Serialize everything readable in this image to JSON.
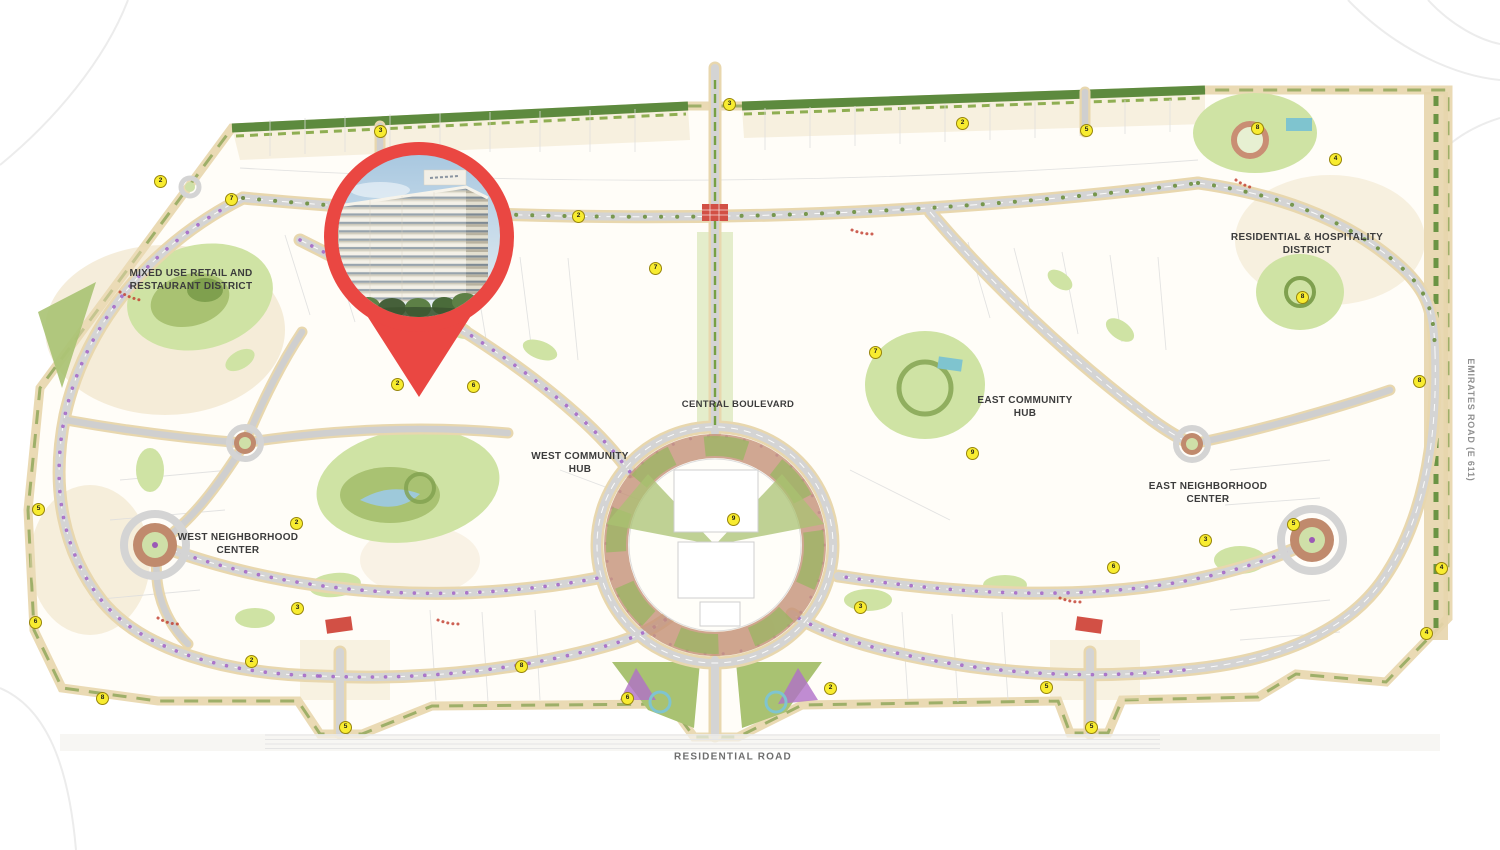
{
  "map": {
    "districts": {
      "mixed_use": "MIXED USE RETAIL AND\nRESTAURANT DISTRICT",
      "central_boulevard": "CENTRAL BOULEVARD",
      "west_community_hub": "WEST COMMUNITY\nHUB",
      "east_community_hub": "EAST COMMUNITY\nHUB",
      "west_neighborhood_center": "WEST NEIGHBORHOOD\nCENTER",
      "east_neighborhood_center": "EAST NEIGHBORHOOD\nCENTER",
      "residential_hospitality": "RESIDENTIAL & HOSPITALITY\nDISTRICT"
    },
    "roads": {
      "residential_road": "RESIDENTIAL ROAD",
      "emirates_road": "EMIRATES ROAD (E 611)"
    },
    "markers": [
      {
        "x": 160,
        "y": 181,
        "n": "2"
      },
      {
        "x": 231,
        "y": 199,
        "n": "7"
      },
      {
        "x": 380,
        "y": 131,
        "n": "3"
      },
      {
        "x": 578,
        "y": 216,
        "n": "2"
      },
      {
        "x": 729,
        "y": 104,
        "n": "3"
      },
      {
        "x": 655,
        "y": 268,
        "n": "7"
      },
      {
        "x": 962,
        "y": 123,
        "n": "2"
      },
      {
        "x": 1086,
        "y": 130,
        "n": "5"
      },
      {
        "x": 1257,
        "y": 128,
        "n": "8"
      },
      {
        "x": 1335,
        "y": 159,
        "n": "4"
      },
      {
        "x": 1302,
        "y": 297,
        "n": "8"
      },
      {
        "x": 1419,
        "y": 381,
        "n": "8"
      },
      {
        "x": 1441,
        "y": 568,
        "n": "4"
      },
      {
        "x": 1426,
        "y": 633,
        "n": "4"
      },
      {
        "x": 38,
        "y": 509,
        "n": "5"
      },
      {
        "x": 35,
        "y": 622,
        "n": "6"
      },
      {
        "x": 102,
        "y": 698,
        "n": "8"
      },
      {
        "x": 297,
        "y": 608,
        "n": "3"
      },
      {
        "x": 345,
        "y": 727,
        "n": "5"
      },
      {
        "x": 251,
        "y": 661,
        "n": "2"
      },
      {
        "x": 521,
        "y": 666,
        "n": "8"
      },
      {
        "x": 627,
        "y": 698,
        "n": "6"
      },
      {
        "x": 860,
        "y": 607,
        "n": "3"
      },
      {
        "x": 830,
        "y": 688,
        "n": "2"
      },
      {
        "x": 1046,
        "y": 687,
        "n": "5"
      },
      {
        "x": 1091,
        "y": 727,
        "n": "5"
      },
      {
        "x": 1113,
        "y": 567,
        "n": "6"
      },
      {
        "x": 1293,
        "y": 524,
        "n": "5"
      },
      {
        "x": 972,
        "y": 453,
        "n": "9"
      },
      {
        "x": 397,
        "y": 384,
        "n": "2"
      },
      {
        "x": 473,
        "y": 386,
        "n": "6"
      },
      {
        "x": 296,
        "y": 523,
        "n": "2"
      },
      {
        "x": 1205,
        "y": 540,
        "n": "3"
      },
      {
        "x": 875,
        "y": 352,
        "n": "7"
      },
      {
        "x": 733,
        "y": 519,
        "n": "9"
      }
    ]
  },
  "pin": {
    "icon": "location-pin-icon",
    "photo": "residential-building-render"
  },
  "colors": {
    "pin_red": "#ea4742",
    "marker_yellow": "#f8ec30",
    "road_gray": "#d4d4d4",
    "sand": "#e8d7ae",
    "park_green": "#cfe3a4",
    "hedge_green": "#6c8f3e",
    "terracotta": "#c08a6d",
    "purple_tree": "#a061c6",
    "water_teal": "#8fc7d1"
  }
}
